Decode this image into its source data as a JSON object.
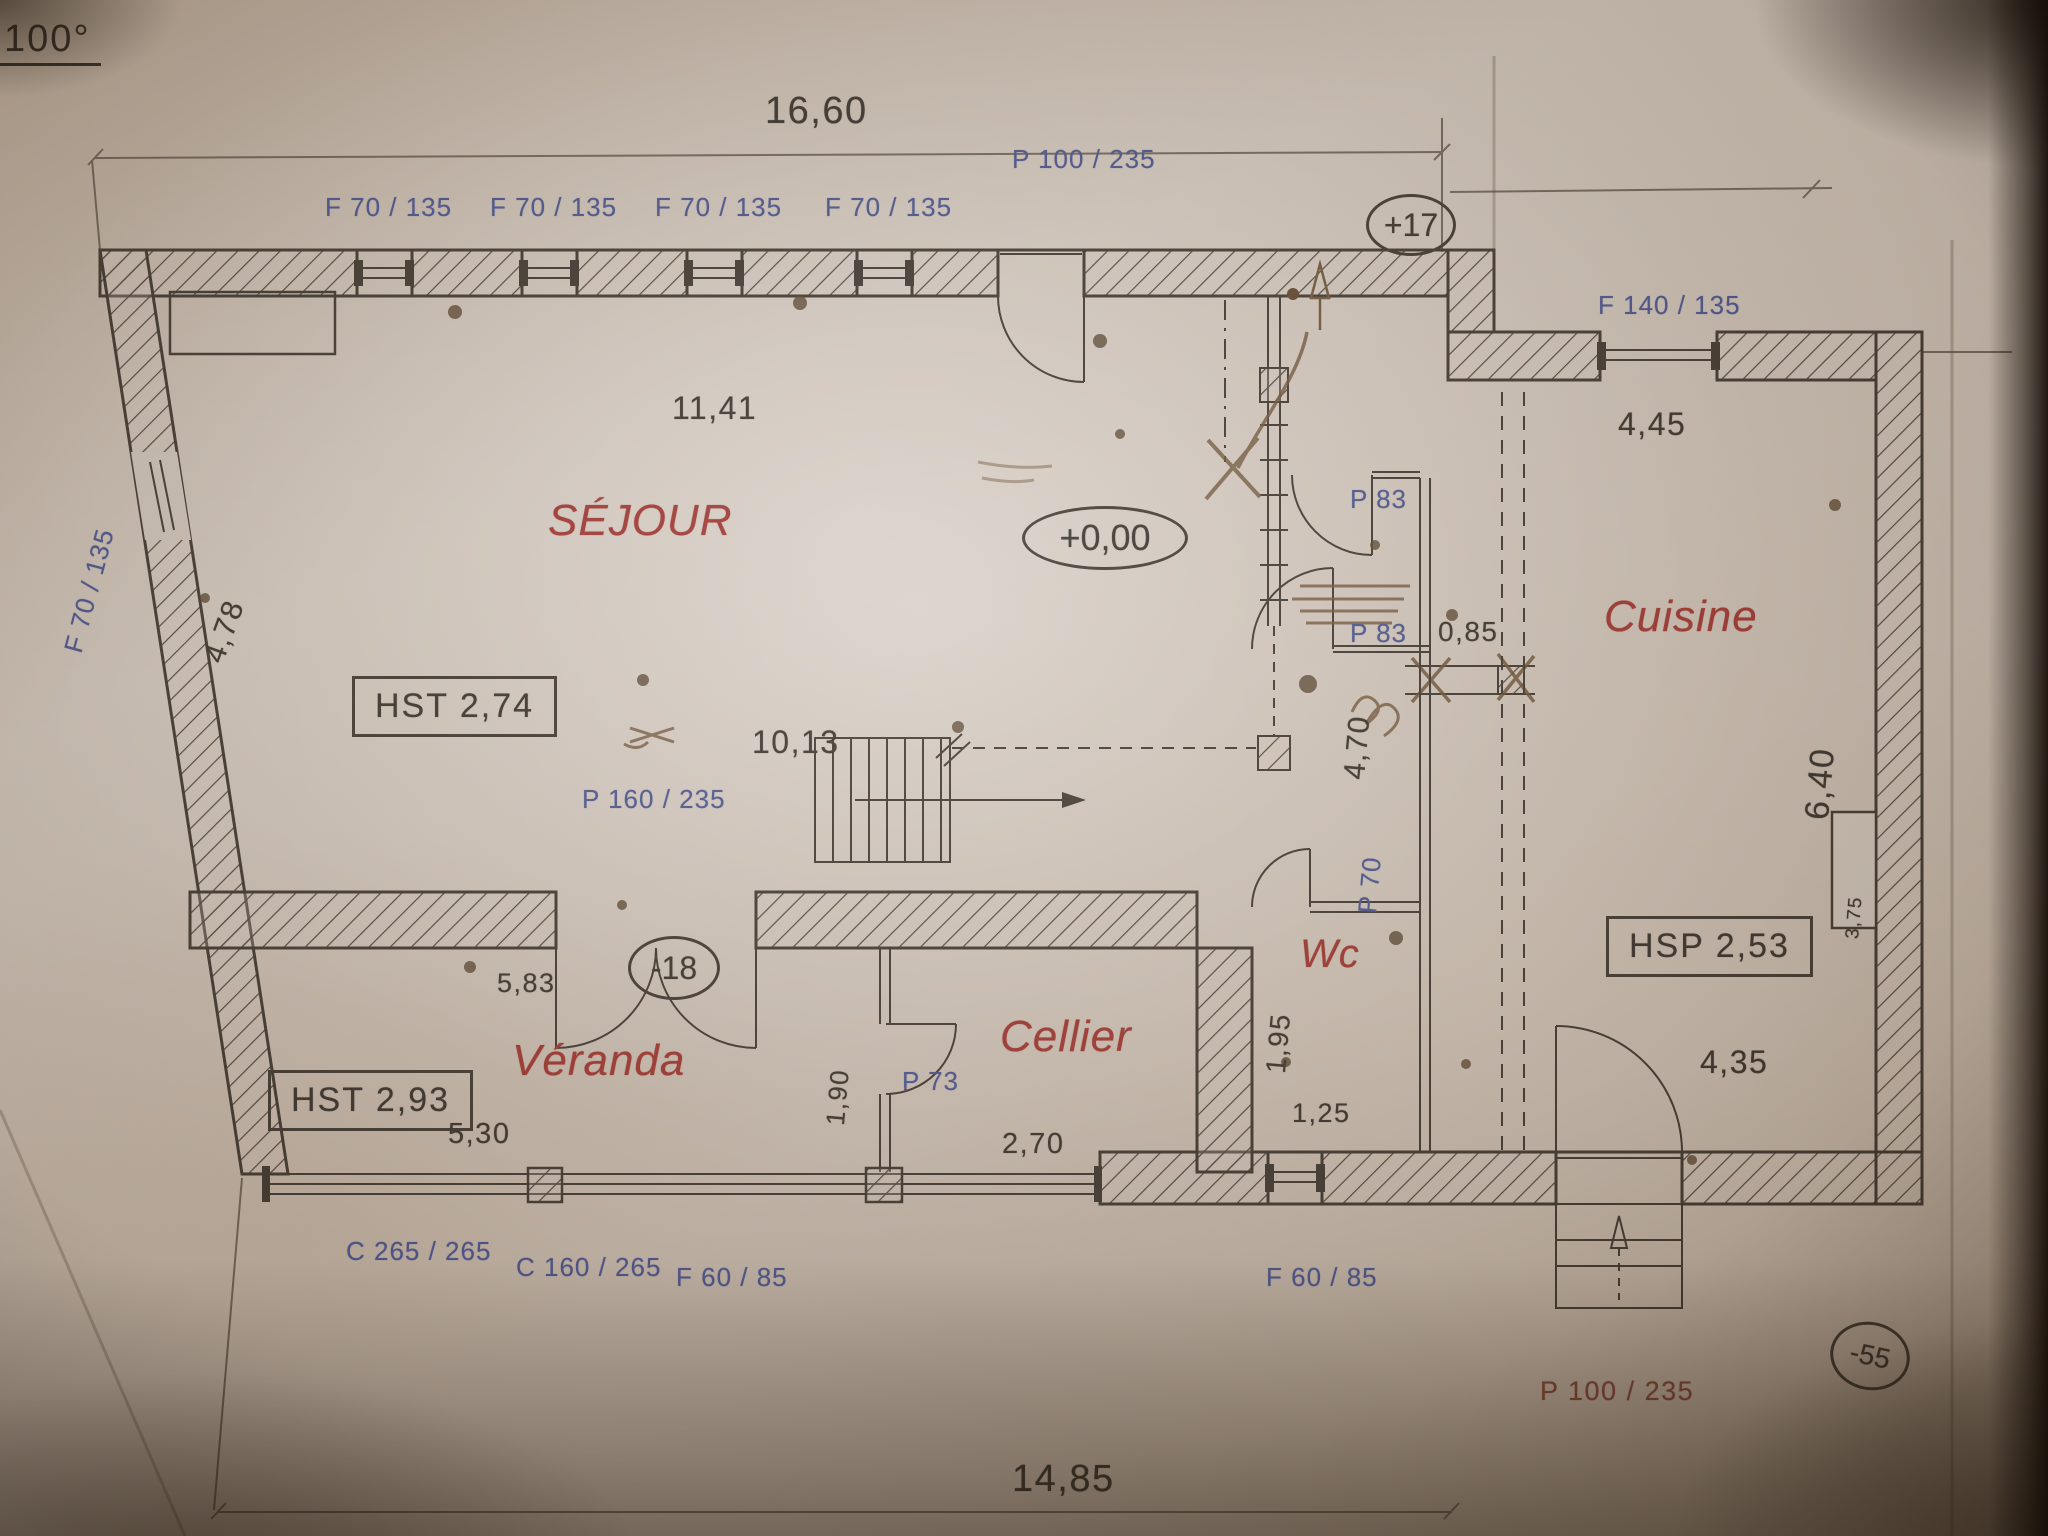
{
  "document": {
    "type_note": "100°",
    "levels": {
      "entry": "+17",
      "ground": "+0,00",
      "veranda": "-18",
      "porch": "-55"
    },
    "rooms": {
      "sejour": "SÉJOUR",
      "cuisine": "Cuisine",
      "wc": "Wc",
      "cellier": "Cellier",
      "veranda": "Véranda"
    },
    "ceiling_heights": {
      "sejour": "HST 2,74",
      "cuisine": "HSP 2,53",
      "veranda": "HST 2,93"
    },
    "dimensions": {
      "overall_top": "16,60",
      "overall_bottom": "14,85",
      "sejour_wall": "11,41",
      "sejour_inner": "10,13",
      "left_wall": "4,78",
      "cuisine_top": "4,45",
      "cuisine_right": "6,40",
      "cuisine_flue": "3,75",
      "cuisine_bottom": "4,35",
      "hall": "4,70",
      "hall_gap": "0,85",
      "veranda_left": "5,83",
      "veranda_front": "5,30",
      "cellier_front": "2,70",
      "cellier_side": "1,90",
      "wc_side": "1,95",
      "wc_front": "1,25"
    },
    "openings": {
      "top_windows": [
        "F 70 / 135",
        "F 70 / 135",
        "F 70 / 135",
        "F 70 / 135"
      ],
      "left_window": "F 70 / 135",
      "wide_window": "F 140 / 135",
      "entry_door": "P 100 / 235",
      "hall_door_1": "P 83",
      "hall_door_2": "P 83",
      "sejour_double_door": "P 160 / 235",
      "wc_door": "P 70",
      "cellier_door": "P 73",
      "veranda_glazing_1": "C 265 / 265",
      "veranda_glazing_2": "C 160 / 265",
      "front_window_1": "F 60 / 85",
      "front_window_2": "F 60 / 85",
      "back_door": "P 100 / 235"
    }
  }
}
